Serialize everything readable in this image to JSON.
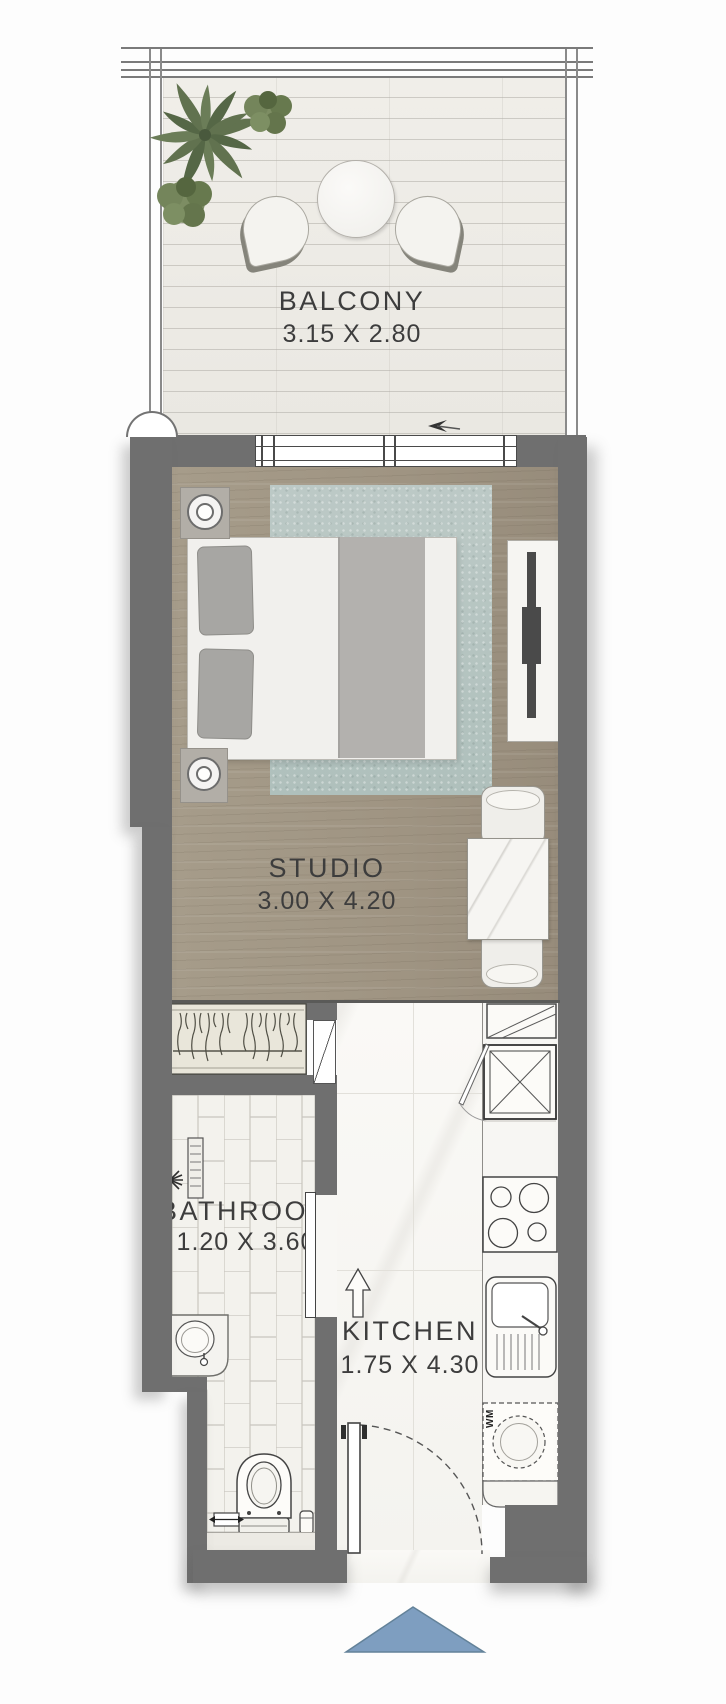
{
  "rooms": {
    "balcony": {
      "label": "BALCONY",
      "size": "3.15 X 2.80"
    },
    "studio": {
      "label": "STUDIO",
      "size": "3.00 X 4.20"
    },
    "bathroom": {
      "label": "BATHROOM",
      "size": "1.20 X 3.60"
    },
    "kitchen": {
      "label": "KITCHEN",
      "size": "1.75 X 4.30"
    }
  },
  "appliances": {
    "washer_label": "WM"
  },
  "colors": {
    "wall": "#6f6f6f",
    "wood_floor": "#a29885",
    "balcony_floor": "#eeece7",
    "kitchen_floor": "#f8f7f4",
    "rug": "#b8c7c3",
    "entrance_marker": "#7e9ec0",
    "text": "#3d3d3d"
  }
}
